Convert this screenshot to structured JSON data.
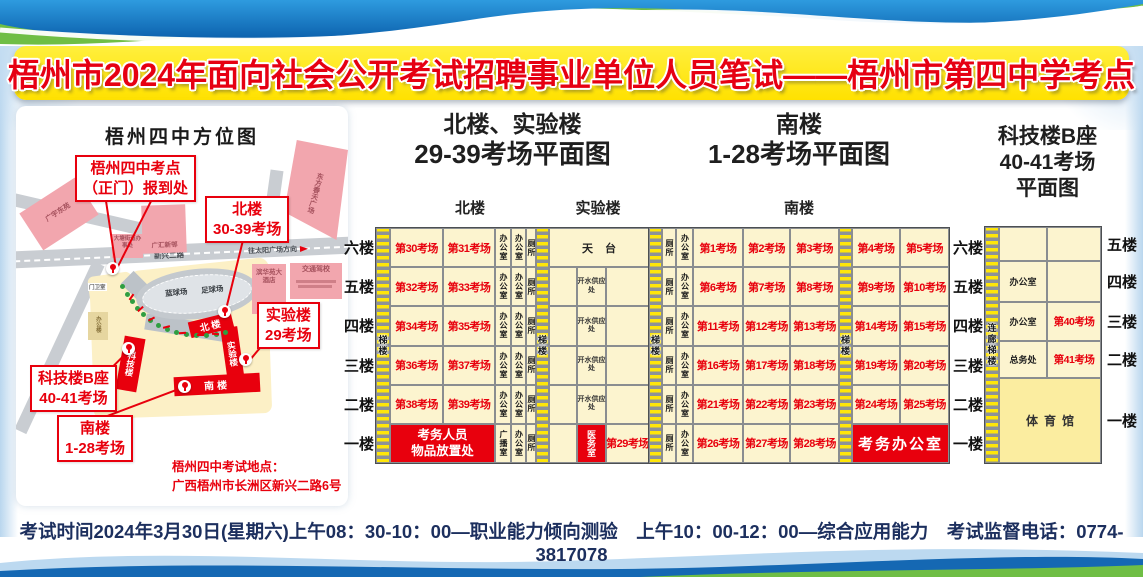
{
  "title": "梧州市2024年面向社会公开考试招聘事业单位人员笔试——梧州市第四中学考点",
  "map": {
    "title": "梧州四中方位图",
    "callout_gate": [
      "梧州四中考点",
      "（正门）报到处"
    ],
    "callout_north": [
      "北楼",
      "30-39考场"
    ],
    "callout_lab": [
      "实验楼",
      "29考场"
    ],
    "callout_tech": [
      "科技楼B座",
      "40-41考场"
    ],
    "callout_south": [
      "南楼",
      "1-28考场"
    ],
    "address": [
      "梧州四中考试地点：",
      "广西梧州市长洲区新兴二路6号"
    ],
    "roads": {
      "xinxing_diag": "新兴二路",
      "xinxing_main": "新兴二路",
      "direction": "往太阳广场方向"
    },
    "places": {
      "gyd": "广宇东苑",
      "datang": "大塘街道办事处",
      "ghxc": "广汇新邨",
      "dfct": "东方春天广场",
      "bhy": "滨华苑大酒店",
      "jtjx": "交通驾校",
      "gatehouse": "门卫室",
      "office": "办公楼",
      "basketball": "蓝球场",
      "football": "足球场"
    },
    "campus": {
      "north": "北楼",
      "lab": "实验楼",
      "south": "南楼",
      "tech": "科技楼"
    }
  },
  "plans": {
    "north_lab": {
      "title": [
        "北楼、实验楼",
        "29-39考场平面图"
      ],
      "sub_north": "北楼",
      "sub_lab": "实验楼",
      "floors": [
        "六楼",
        "五楼",
        "四楼",
        "三楼",
        "二楼",
        "一楼"
      ],
      "stair_label": "梯楼",
      "rows": [
        {
          "a": "第30考场",
          "b": "第31考场",
          "n": [
            "办公室",
            "办公室",
            "厕所"
          ]
        },
        {
          "a": "第32考场",
          "b": "第33考场",
          "n": [
            "办公室",
            "办公室",
            "厕所"
          ]
        },
        {
          "a": "第34考场",
          "b": "第35考场",
          "n": [
            "办公室",
            "办公室",
            "厕所"
          ]
        },
        {
          "a": "第36考场",
          "b": "第37考场",
          "n": [
            "办公室",
            "办公室",
            "厕所"
          ]
        },
        {
          "a": "第38考场",
          "b": "第39考场",
          "n": [
            "办公室",
            "办公室",
            "厕所"
          ]
        },
        {
          "red": [
            "考务人员",
            "物品放置处"
          ],
          "n": [
            "广播室",
            "办公室",
            "厕所"
          ]
        }
      ],
      "lab": {
        "roof": "天台",
        "water": "开水供应处",
        "clinic": "医务室",
        "room29": "第29考场"
      }
    },
    "south": {
      "title": [
        "南楼",
        "1-28考场平面图"
      ],
      "sub": "南楼",
      "floors": [
        "六楼",
        "五楼",
        "四楼",
        "三楼",
        "二楼",
        "一楼"
      ],
      "stair_label": "梯楼",
      "rows": [
        {
          "n": [
            "厕所",
            "办公室"
          ],
          "rooms": [
            "第1考场",
            "第2考场",
            "第3考场",
            "第4考场",
            "第5考场"
          ]
        },
        {
          "n": [
            "厕所",
            "办公室"
          ],
          "rooms": [
            "第6考场",
            "第7考场",
            "第8考场",
            "第9考场",
            "第10考场"
          ]
        },
        {
          "n": [
            "厕所",
            "办公室"
          ],
          "rooms": [
            "第11考场",
            "第12考场",
            "第13考场",
            "第14考场",
            "第15考场"
          ]
        },
        {
          "n": [
            "厕所",
            "办公室"
          ],
          "rooms": [
            "第16考场",
            "第17考场",
            "第18考场",
            "第19考场",
            "第20考场"
          ]
        },
        {
          "n": [
            "厕所",
            "办公室"
          ],
          "rooms": [
            "第21考场",
            "第22考场",
            "第23考场",
            "第24考场",
            "第25考场"
          ]
        },
        {
          "n": [
            "厕所",
            "办公室"
          ],
          "rooms": [
            "第26考场",
            "第27考场",
            "第28考场"
          ],
          "red": "考务办公室"
        }
      ]
    },
    "tech": {
      "title": [
        "科技楼B座",
        "40-41考场",
        "平面图"
      ],
      "floors": [
        "五楼",
        "四楼",
        "三楼",
        "二楼",
        "一楼"
      ],
      "stair_label": "连廊梯楼",
      "rows": [
        [
          "",
          ""
        ],
        [
          "办公室",
          ""
        ],
        [
          "办公室",
          "第40考场"
        ],
        [
          "总务处",
          "第41考场"
        ]
      ],
      "gym": "体育馆"
    }
  },
  "footer": {
    "text": "考试时间2024年3月30日(星期六)上午08：30-10：00—职业能力倾向测验　上午10：00-12：00—综合应用能力　考试监督电话：0774-3817078"
  },
  "colors": {
    "accent_red": "#e8000d",
    "banner_yellow": "#ffe60a",
    "cell_cream": "#fcf4cf",
    "wave_blue": "#1568b3",
    "wave_green": "#6fbe45"
  }
}
